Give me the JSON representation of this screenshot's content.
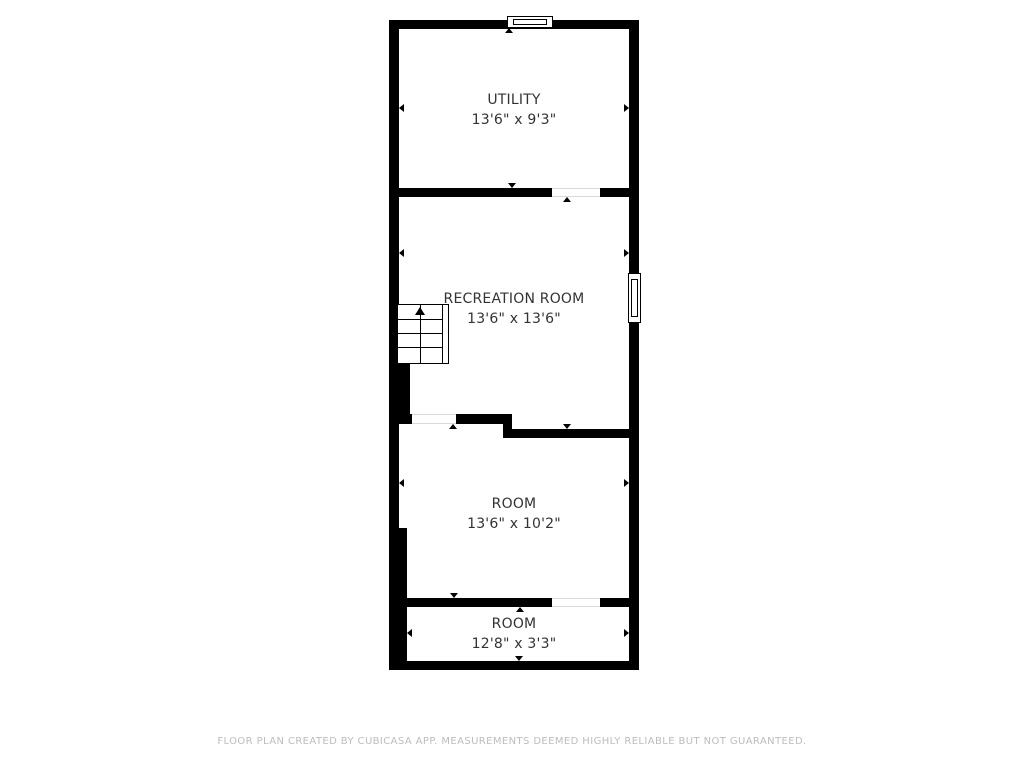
{
  "colors": {
    "background": "#ffffff",
    "wall": "#000000",
    "room_text": "#333333",
    "footer_text": "#bdbdbd",
    "door_opening_line": "#d9d9d9"
  },
  "floor_plan": {
    "rooms": [
      {
        "name": "UTILITY",
        "dims": "13'6\" x 9'3\""
      },
      {
        "name": "RECREATION ROOM",
        "dims": "13'6\" x 13'6\""
      },
      {
        "name": "ROOM",
        "dims": "13'6\" x 10'2\""
      },
      {
        "name": "ROOM",
        "dims": "12'8\" x 3'3\""
      }
    ],
    "icons": {
      "stairs_up_arrow": "▲",
      "measurement_arrow": "▸",
      "window_symbol": "double-line-rect",
      "door_opening": "wall-gap"
    }
  },
  "footer": {
    "text": "FLOOR PLAN CREATED BY CUBICASA APP. MEASUREMENTS DEEMED HIGHLY RELIABLE BUT NOT GUARANTEED."
  }
}
